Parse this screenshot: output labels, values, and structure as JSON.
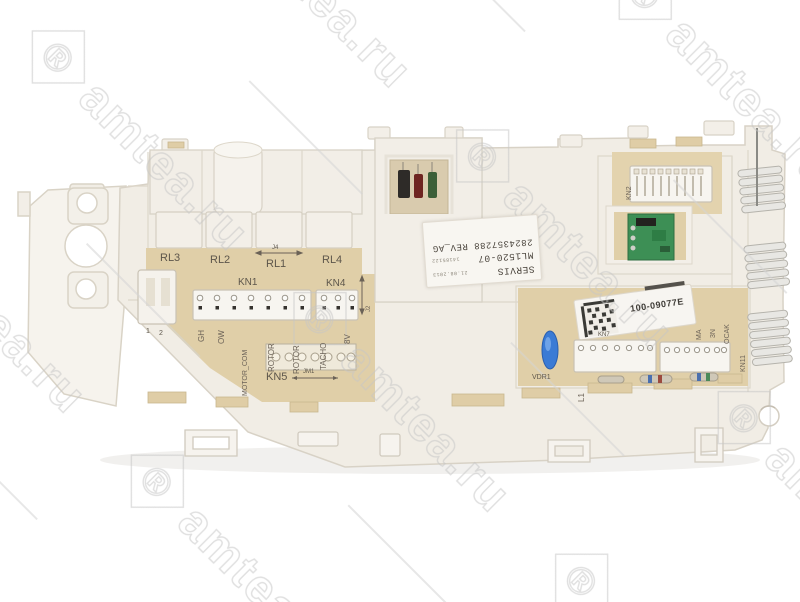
{
  "watermark": {
    "brand": "amtea.ru",
    "registered": "®"
  },
  "labels": {
    "rl3": "RL3",
    "rl2": "RL2",
    "rl1": "RL1",
    "rl4": "RL4",
    "j4": "J4",
    "kn1": "KN1",
    "kn4": "KN4",
    "kn5": "KN5",
    "jm1": "JM1",
    "j2": "J2",
    "kn7": "KN7",
    "kn2": "KN2",
    "kn11": "KN11",
    "vdr1": "VDR1",
    "pin1": "1",
    "pin2": "2"
  },
  "kn1_pins": [
    "GH",
    "OW",
    "MOTOR_COM",
    "ROTOR",
    "ROTOR"
  ],
  "kn4_pins": [
    "TACHO",
    "8V"
  ],
  "kn7_pins": [
    "L1"
  ],
  "kn11_pins": [
    "MA",
    "3N",
    "OCAK"
  ],
  "part_code": "100-09077E",
  "sticker": {
    "line1": "SERVIS",
    "line1_note": "21.08.2013",
    "line2": "ML1520-07",
    "line2_note": "14185122",
    "line3": "2824357288 REV_AG"
  },
  "colors": {
    "pcb": "#e0cfa8",
    "plastic": "#f1ede5",
    "green_pcb": "#3d8f55",
    "varistor": "#3a7bd5",
    "watermark": "#c6c6c6"
  }
}
